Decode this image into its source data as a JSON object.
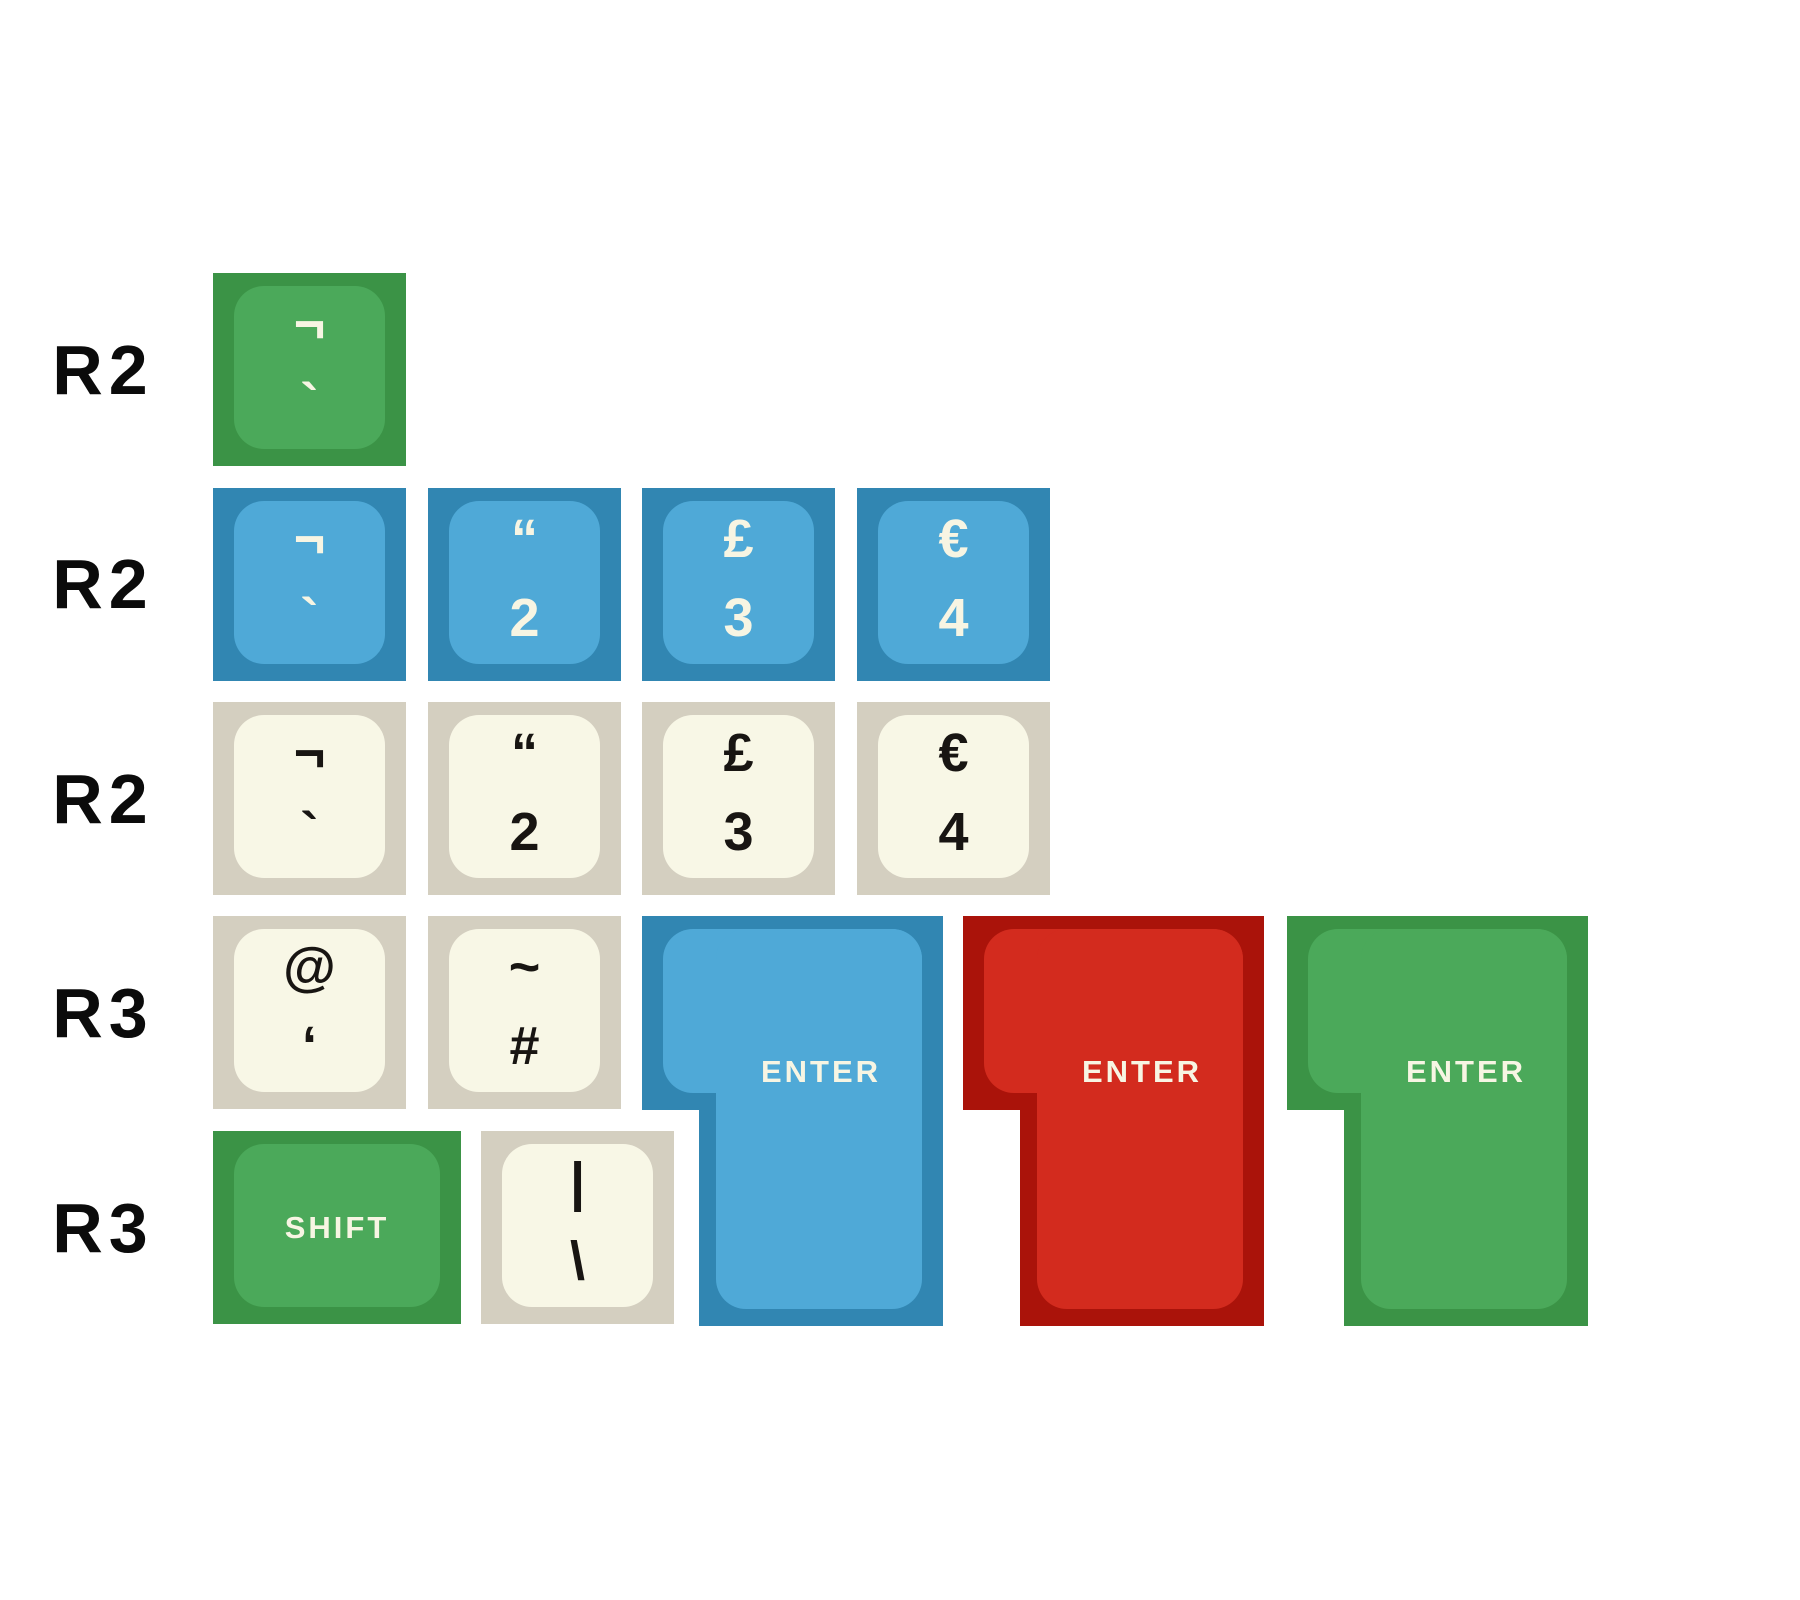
{
  "colors": {
    "background": "#ffffff",
    "green_outer": "#3b9346",
    "green_inner": "#4ba95a",
    "blue_outer": "#3186b2",
    "blue_inner": "#4fa9d7",
    "cream_outer": "#d4cfc0",
    "cream_inner": "#f8f7e6",
    "red_outer": "#aa130a",
    "red_inner": "#d32b1e",
    "legend_light": "#f7f5e3",
    "legend_dark": "#181512",
    "label": "#0b0b0b"
  },
  "row_labels": [
    "R2",
    "R2",
    "R2",
    "R3",
    "R3"
  ],
  "keys": {
    "green_grave": {
      "top": "¬",
      "bottom": "`"
    },
    "blue_grave": {
      "top": "¬",
      "bottom": "`"
    },
    "blue_2": {
      "top": "“",
      "bottom": "2"
    },
    "blue_3": {
      "top": "£",
      "bottom": "3"
    },
    "blue_4": {
      "top": "€",
      "bottom": "4"
    },
    "cream_grave": {
      "top": "¬",
      "bottom": "`"
    },
    "cream_2": {
      "top": "“",
      "bottom": "2"
    },
    "cream_3": {
      "top": "£",
      "bottom": "3"
    },
    "cream_4": {
      "top": "€",
      "bottom": "4"
    },
    "cream_quote": {
      "top": "@",
      "bottom": "‘"
    },
    "cream_hash": {
      "top": "~",
      "bottom": "#"
    },
    "shift": {
      "label": "SHIFT"
    },
    "cream_backslash": {
      "top": "|",
      "bottom": "\\"
    },
    "enter_blue": {
      "label": "ENTER"
    },
    "enter_red": {
      "label": "ENTER"
    },
    "enter_green": {
      "label": "ENTER"
    }
  }
}
